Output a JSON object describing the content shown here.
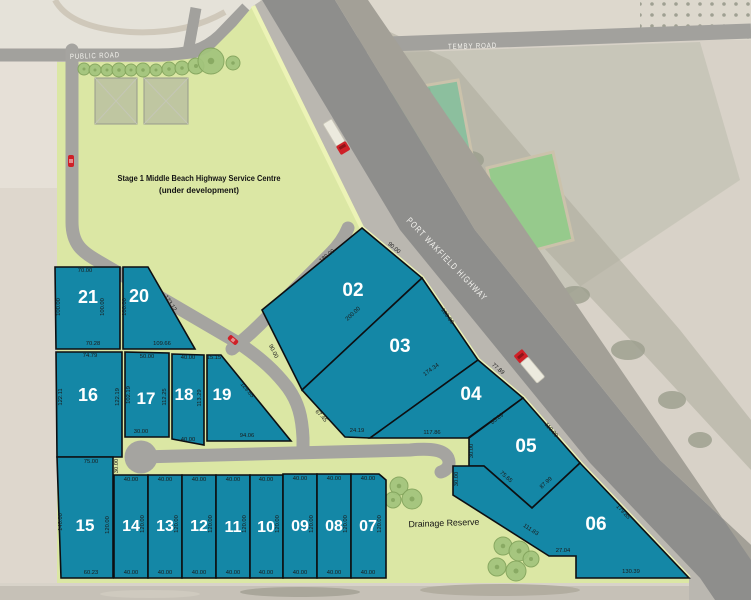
{
  "map": {
    "colors": {
      "lot_fill": "#1487a6",
      "lot_stroke": "#0d0f12",
      "green": "#dbe7a4",
      "verge_line": "#ecf3b6",
      "highway_main": "#8e8e8c",
      "highway_shoulder": "#bab7b0",
      "road_internal": "#a5a4a0",
      "vehicle_red": "#cf2027"
    },
    "trees_service_row": [
      [
        84,
        69,
        6
      ],
      [
        95,
        70,
        6
      ],
      [
        107,
        70,
        6
      ],
      [
        119,
        70,
        7
      ],
      [
        131,
        70,
        6
      ],
      [
        143,
        70,
        7
      ],
      [
        156,
        70,
        6
      ],
      [
        169,
        69,
        7
      ],
      [
        182,
        68,
        7
      ],
      [
        196,
        66,
        8
      ],
      [
        211,
        61,
        13
      ],
      [
        233,
        63,
        7
      ]
    ],
    "trees_drainage": [
      [
        399,
        486,
        9
      ],
      [
        412,
        499,
        10
      ],
      [
        393,
        500,
        8
      ],
      [
        503,
        546,
        9
      ],
      [
        519,
        551,
        10
      ],
      [
        497,
        567,
        9
      ],
      [
        516,
        571,
        10
      ],
      [
        531,
        559,
        8
      ]
    ]
  },
  "roads": {
    "temby": {
      "label": "TEMBY ROAD"
    },
    "public": {
      "label": "PUBLIC ROAD"
    },
    "highway": {
      "label": "PORT WAKFIELD HIGHWAY"
    }
  },
  "annotations": {
    "service_centre_line1": "Stage 1 Middle Beach Highway Service Centre",
    "service_centre_line2": "(under development)",
    "drainage": "Drainage Reserve"
  },
  "lots": [
    {
      "number": "02",
      "points": "362,228 422,278 302,390 262,310",
      "label": [
        353,
        296,
        19
      ],
      "dims": [
        [
          "180.00",
          328,
          257,
          -39
        ],
        [
          "90.00",
          393,
          249,
          40
        ],
        [
          "200.00",
          354,
          315,
          -43
        ],
        [
          "90.00",
          272,
          352,
          63
        ]
      ]
    },
    {
      "number": "03",
      "points": "422,278 478,360 370,438 345,437 302,390",
      "label": [
        400,
        352,
        19
      ],
      "dims": [
        [
          "100.00",
          446,
          317,
          55
        ],
        [
          "174.34",
          432,
          371,
          -36
        ],
        [
          "24.19",
          357,
          432,
          0
        ],
        [
          "67.45",
          320,
          417,
          47
        ]
      ]
    },
    {
      "number": "04",
      "points": "478,360 523,398 468,438 370,438",
      "label": [
        471,
        400,
        19
      ],
      "dims": [
        [
          "77.89",
          497,
          370,
          40
        ],
        [
          "85.89",
          498,
          420,
          -37
        ],
        [
          "117.86",
          432,
          434,
          0
        ]
      ]
    },
    {
      "number": "05",
      "points": "523,398 580,463 532,508 484,466 469,466 469,438",
      "label": [
        526,
        452,
        19
      ],
      "dims": [
        [
          "110.00",
          550,
          431,
          49
        ],
        [
          "87.99",
          547,
          484,
          -43
        ],
        [
          "75.65",
          505,
          478,
          41
        ],
        [
          "30.00",
          473,
          451,
          -90
        ]
      ]
    },
    {
      "number": "06",
      "points": "580,463 689,578 576,578 576,556 549,556 453,495 453,466 484,466 532,508",
      "label": [
        596,
        530,
        19
      ],
      "dims": [
        [
          "179.85",
          622,
          513,
          46
        ],
        [
          "130.39",
          631,
          573,
          0
        ],
        [
          "27.04",
          563,
          552,
          0
        ],
        [
          "111.83",
          530,
          531,
          33
        ],
        [
          "30.00",
          458,
          479,
          -90
        ]
      ]
    },
    {
      "number": "20",
      "points": "123,267 148,267 195,349 123,349",
      "label": [
        139,
        302,
        18
      ],
      "dims": [
        [
          "123.12",
          169,
          304,
          57
        ],
        [
          "109.66",
          162,
          345,
          0
        ],
        [
          "100.00",
          126,
          307,
          -90
        ]
      ]
    },
    {
      "number": "21",
      "points": "55,267 120,267 120,349 56,349",
      "label": [
        88,
        303,
        18
      ],
      "dims": [
        [
          "70.00",
          85,
          272,
          0
        ],
        [
          "100.00",
          60,
          307,
          -90
        ],
        [
          "100.00",
          104,
          307,
          -90
        ],
        [
          "70.28",
          93,
          345,
          0
        ]
      ]
    },
    {
      "number": "16",
      "points": "56,352 122,352 122,457 57,457",
      "label": [
        88,
        401,
        18
      ],
      "dims": [
        [
          "74.79",
          90,
          357,
          0
        ],
        [
          "122.11",
          62,
          397,
          -90
        ],
        [
          "122.19",
          119,
          397,
          -90
        ]
      ]
    },
    {
      "number": "17",
      "points": "125,352 169,353 169,437 125,437",
      "label": [
        146,
        404,
        17
      ],
      "dims": [
        [
          "50.00",
          147,
          358,
          0
        ],
        [
          "102.19",
          130,
          395,
          -90
        ],
        [
          "112.25",
          166,
          397,
          -90
        ],
        [
          "30.00",
          141,
          433,
          0
        ]
      ]
    },
    {
      "number": "18",
      "points": "172,354 204,355 204,445 172,439",
      "label": [
        184,
        400,
        17
      ],
      "dims": [
        [
          "40.00",
          188,
          359,
          0
        ],
        [
          "113.29",
          201,
          398,
          -90
        ],
        [
          "40.00",
          188,
          441,
          0
        ]
      ]
    },
    {
      "number": "19",
      "points": "207,355 221,355 291,441 207,441",
      "label": [
        222,
        400,
        17
      ],
      "dims": [
        [
          "15.15",
          214,
          359,
          0
        ],
        [
          "129.65",
          246,
          391,
          50
        ],
        [
          "94.06",
          247,
          437,
          0
        ]
      ]
    },
    {
      "number": "15",
      "points": "57,457 113,457 113,578 61,578",
      "label": [
        85,
        531,
        17
      ],
      "dims": [
        [
          "75.00",
          91,
          463,
          0
        ],
        [
          "30.00",
          118,
          466,
          -90
        ],
        [
          "140.00",
          62,
          522,
          -90
        ],
        [
          "120.00",
          109,
          525,
          -90
        ],
        [
          "60.23",
          91,
          574,
          0
        ]
      ]
    },
    {
      "number": "14",
      "points": "114,475 148,475 148,578 114,578",
      "label": [
        131,
        531,
        16
      ],
      "dims": [
        [
          "40.00",
          131,
          481,
          0
        ],
        [
          "120.00",
          144,
          524,
          -90
        ],
        [
          "40.00",
          131,
          574,
          0
        ]
      ]
    },
    {
      "number": "13",
      "points": "148,475 182,475 182,578 148,578",
      "label": [
        165,
        531,
        16
      ],
      "dims": [
        [
          "40.00",
          165,
          481,
          0
        ],
        [
          "120.00",
          178,
          524,
          -90
        ],
        [
          "40.00",
          165,
          574,
          0
        ]
      ]
    },
    {
      "number": "12",
      "points": "182,475 216,475 216,578 182,578",
      "label": [
        199,
        531,
        16
      ],
      "dims": [
        [
          "40.00",
          199,
          481,
          0
        ],
        [
          "120.00",
          212,
          524,
          -90
        ],
        [
          "40.00",
          199,
          574,
          0
        ]
      ]
    },
    {
      "number": "11",
      "points": "216,475 250,475 250,578 216,578",
      "label": [
        233,
        532,
        16
      ],
      "dims": [
        [
          "40.00",
          233,
          481,
          0
        ],
        [
          "120.00",
          246,
          524,
          -90
        ],
        [
          "40.00",
          233,
          574,
          0
        ]
      ]
    },
    {
      "number": "10",
      "points": "250,475 283,475 283,578 250,578",
      "label": [
        266,
        532,
        16
      ],
      "dims": [
        [
          "40.00",
          266,
          481,
          0
        ],
        [
          "120.00",
          279,
          524,
          -90
        ],
        [
          "40.00",
          266,
          574,
          0
        ]
      ]
    },
    {
      "number": "09",
      "points": "283,474 317,474 317,578 283,578",
      "label": [
        300,
        531,
        16
      ],
      "dims": [
        [
          "40.00",
          300,
          480,
          0
        ],
        [
          "120.00",
          313,
          524,
          -90
        ],
        [
          "40.00",
          300,
          574,
          0
        ]
      ]
    },
    {
      "number": "08",
      "points": "317,474 351,474 351,578 317,578",
      "label": [
        334,
        531,
        16
      ],
      "dims": [
        [
          "40.00",
          334,
          480,
          0
        ],
        [
          "120.00",
          347,
          524,
          -90
        ],
        [
          "40.00",
          334,
          574,
          0
        ]
      ]
    },
    {
      "number": "07",
      "points": "351,474 379,474 386,480 386,578 351,578",
      "label": [
        368,
        531,
        16
      ],
      "dims": [
        [
          "40.00",
          368,
          480,
          0
        ],
        [
          "120.00",
          381,
          524,
          -90
        ],
        [
          "40.00",
          368,
          574,
          0
        ]
      ]
    }
  ]
}
